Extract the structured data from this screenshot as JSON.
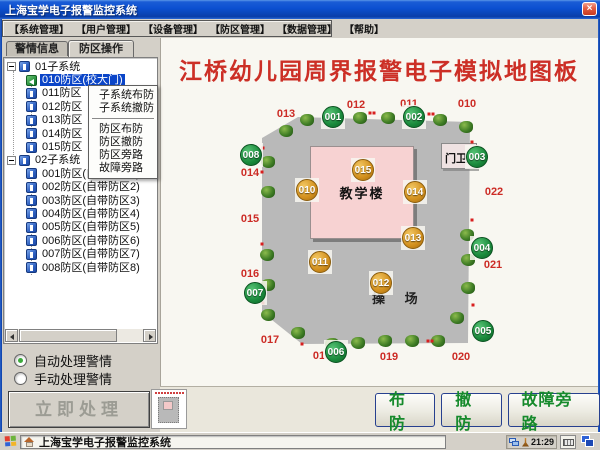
{
  "window": {
    "title": "上海宝学电子报警监控系统",
    "close_label": "×"
  },
  "menu_bar": [
    "【系统管理】",
    "【用户管理】",
    "【设备管理】",
    "【防区管理】",
    "【数据管理】",
    "【帮助】"
  ],
  "tabs": [
    {
      "label": "警情信息",
      "active": false
    },
    {
      "label": "防区操作",
      "active": true
    }
  ],
  "tree": {
    "items": [
      {
        "label": "01子系统",
        "level": 0,
        "icon": "blue",
        "selected": false
      },
      {
        "label": "010防区(校大门)",
        "level": 1,
        "icon": "green",
        "selected": true
      },
      {
        "label": "011防区",
        "level": 1,
        "icon": "blue",
        "selected": false
      },
      {
        "label": "012防区",
        "level": 1,
        "icon": "blue",
        "selected": false
      },
      {
        "label": "013防区",
        "level": 1,
        "icon": "blue",
        "selected": false
      },
      {
        "label": "014防区",
        "level": 1,
        "icon": "blue",
        "selected": false
      },
      {
        "label": "015防区",
        "level": 1,
        "icon": "blue",
        "selected": false
      },
      {
        "label": "02子系统",
        "level": 0,
        "icon": "blue",
        "selected": false
      },
      {
        "label": "001防区(自带防区1)",
        "level": 1,
        "icon": "blue",
        "selected": false
      },
      {
        "label": "002防区(自带防区2)",
        "level": 1,
        "icon": "blue",
        "selected": false
      },
      {
        "label": "003防区(自带防区3)",
        "level": 1,
        "icon": "blue",
        "selected": false
      },
      {
        "label": "004防区(自带防区4)",
        "level": 1,
        "icon": "blue",
        "selected": false
      },
      {
        "label": "005防区(自带防区5)",
        "level": 1,
        "icon": "blue",
        "selected": false
      },
      {
        "label": "006防区(自带防区6)",
        "level": 1,
        "icon": "blue",
        "selected": false
      },
      {
        "label": "007防区(自带防区7)",
        "level": 1,
        "icon": "blue",
        "selected": false
      },
      {
        "label": "008防区(自带防区8)",
        "level": 1,
        "icon": "blue",
        "selected": false
      }
    ]
  },
  "context_menu": {
    "items": [
      "子系统布防",
      "子系统撤防",
      "防区布防",
      "防区撤防",
      "防区旁路",
      "故障旁路"
    ],
    "separator_after_index": 1
  },
  "alarm_handling": {
    "options": [
      {
        "label": "自动处理警情",
        "checked": true
      },
      {
        "label": "手动处理警情",
        "checked": false
      }
    ],
    "process_button": "立即处理"
  },
  "map": {
    "title": "江桥幼儿园周界报警电子模拟地图板",
    "building_label": "教学楼",
    "gate_label": "门卫",
    "playground_label": "操 场",
    "armed_color": "#1a8a3c",
    "alert_color": "#d3901d",
    "label_color": "#cc2b25",
    "markers": [
      {
        "id": "001",
        "x": 333,
        "y": 117,
        "state": "green"
      },
      {
        "id": "002",
        "x": 414,
        "y": 117,
        "state": "green"
      },
      {
        "id": "003",
        "x": 477,
        "y": 157,
        "state": "green"
      },
      {
        "id": "004",
        "x": 482,
        "y": 248,
        "state": "green"
      },
      {
        "id": "005",
        "x": 483,
        "y": 331,
        "state": "green"
      },
      {
        "id": "006",
        "x": 336,
        "y": 352,
        "state": "green"
      },
      {
        "id": "007",
        "x": 255,
        "y": 293,
        "state": "green"
      },
      {
        "id": "008",
        "x": 251,
        "y": 155,
        "state": "green"
      },
      {
        "id": "010",
        "x": 307,
        "y": 190,
        "state": "orange"
      },
      {
        "id": "011",
        "x": 320,
        "y": 262,
        "state": "orange"
      },
      {
        "id": "012",
        "x": 381,
        "y": 283,
        "state": "orange"
      },
      {
        "id": "013",
        "x": 413,
        "y": 238,
        "state": "orange"
      },
      {
        "id": "014",
        "x": 415,
        "y": 192,
        "state": "orange"
      },
      {
        "id": "015",
        "x": 363,
        "y": 170,
        "state": "orange"
      }
    ],
    "zone_labels": [
      {
        "text": "013",
        "x": 286,
        "y": 114
      },
      {
        "text": "012",
        "x": 356,
        "y": 105
      },
      {
        "text": "011",
        "x": 409,
        "y": 104
      },
      {
        "text": "010",
        "x": 467,
        "y": 104
      },
      {
        "text": "014",
        "x": 250,
        "y": 173
      },
      {
        "text": "015",
        "x": 250,
        "y": 219
      },
      {
        "text": "016",
        "x": 250,
        "y": 274
      },
      {
        "text": "017",
        "x": 270,
        "y": 340
      },
      {
        "text": "018",
        "x": 322,
        "y": 356
      },
      {
        "text": "019",
        "x": 389,
        "y": 357
      },
      {
        "text": "020",
        "x": 461,
        "y": 357
      },
      {
        "text": "021",
        "x": 493,
        "y": 265
      },
      {
        "text": "022",
        "x": 494,
        "y": 192
      }
    ],
    "trees": [
      [
        307,
        120
      ],
      [
        360,
        118
      ],
      [
        388,
        118
      ],
      [
        440,
        120
      ],
      [
        466,
        127
      ],
      [
        286,
        131
      ],
      [
        268,
        162
      ],
      [
        268,
        192
      ],
      [
        267,
        255
      ],
      [
        268,
        285
      ],
      [
        268,
        315
      ],
      [
        298,
        333
      ],
      [
        332,
        344
      ],
      [
        358,
        343
      ],
      [
        385,
        341
      ],
      [
        412,
        341
      ],
      [
        438,
        341
      ],
      [
        457,
        318
      ],
      [
        468,
        288
      ],
      [
        468,
        260
      ],
      [
        467,
        235
      ]
    ],
    "sensor_dots": [
      [
        370,
        113
      ],
      [
        374,
        113
      ],
      [
        429,
        114
      ],
      [
        433,
        114
      ],
      [
        472,
        142
      ],
      [
        263,
        148
      ],
      [
        262,
        172
      ],
      [
        262,
        244
      ],
      [
        263,
        303
      ],
      [
        302,
        344
      ],
      [
        428,
        341
      ],
      [
        432,
        341
      ],
      [
        472,
        220
      ],
      [
        473,
        305
      ]
    ]
  },
  "bottom_bar": {
    "buttons": [
      "布防",
      "撤防",
      "故障旁路"
    ]
  },
  "taskbar": {
    "task_label": "上海宝学电子报警监控系统",
    "time": "21:29"
  }
}
